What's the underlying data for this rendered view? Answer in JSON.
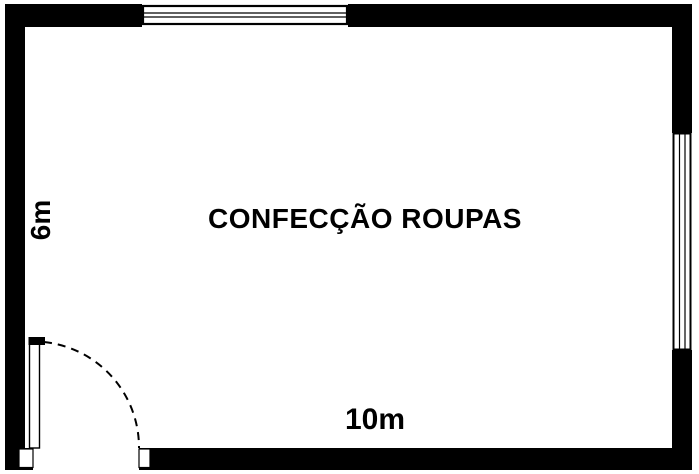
{
  "floor_plan": {
    "room_label": "CONFECÇÃO ROUPAS",
    "left_dimension_label": "6m",
    "bottom_dimension_label": "10m",
    "wall_color": "#000000",
    "line_color": "#000000",
    "background_color": "#ffffff",
    "features": {
      "top_window": "window-symbol",
      "right_window": "window-symbol",
      "door": "door-bottom-left-with-swing-arc"
    }
  }
}
